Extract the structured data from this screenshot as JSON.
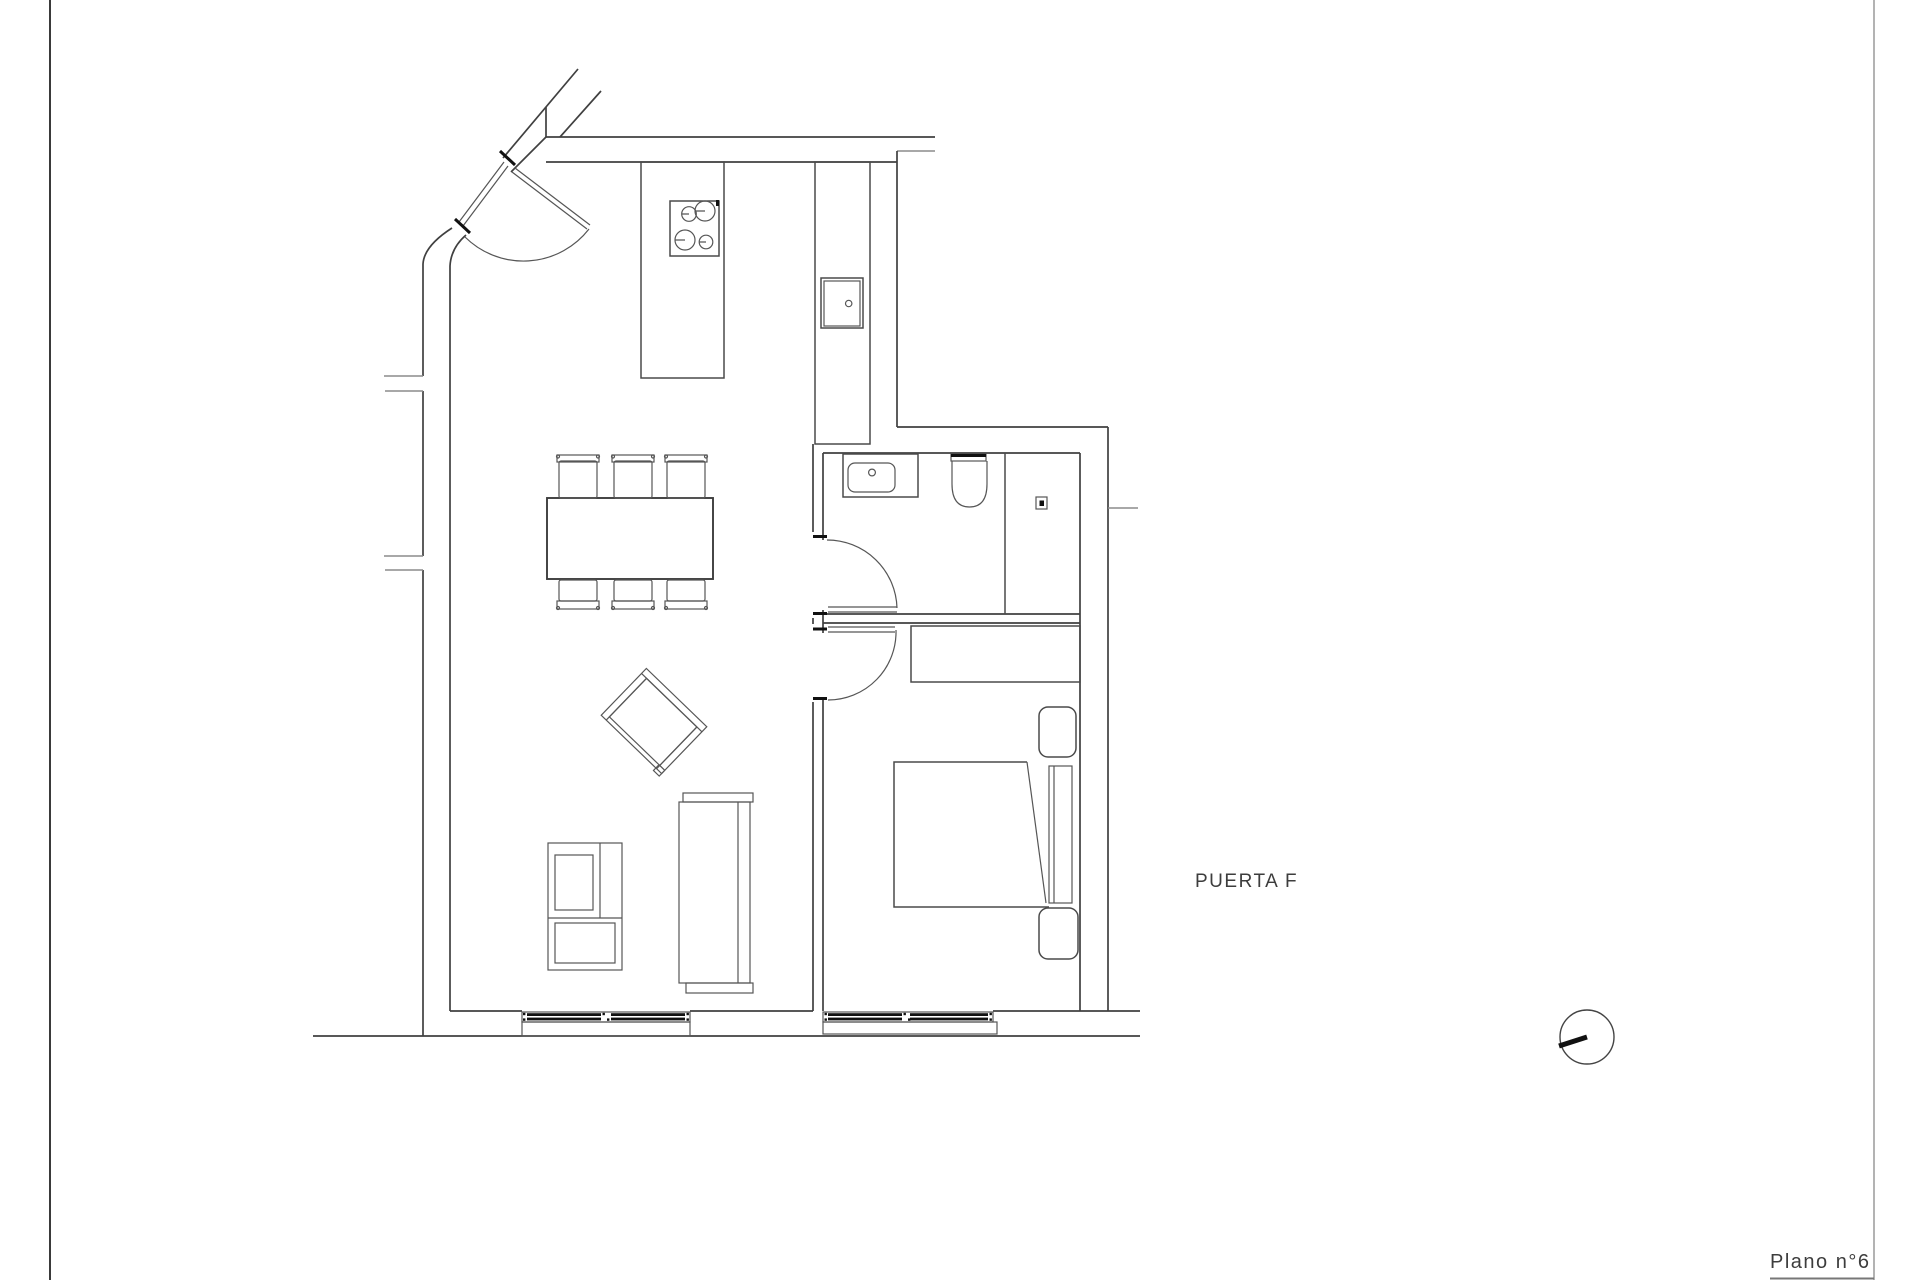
{
  "page": {
    "background": "#ffffff",
    "left_border_color": "#3a3a3a",
    "right_border_color": "#8a8a8a",
    "line_color": "#4a4a4a",
    "accent_black": "#111111"
  },
  "labels": {
    "door_label": "PUERTA F",
    "plan_number": "Plano n°6"
  },
  "drawing": {
    "type": "architectural-floor-plan",
    "symbols": [
      "entrance-door-with-swing",
      "kitchen-counter",
      "stove-4-burners",
      "kitchen-sink",
      "dining-table-6-chairs",
      "armchair-rotated",
      "sofa",
      "tv-cabinet",
      "bathroom-sink",
      "toilet",
      "shower-drain",
      "bathroom-door-with-swing",
      "bedroom-door-with-swing",
      "wardrobe",
      "double-bed",
      "nightstand-top",
      "nightstand-bottom",
      "window-living-room",
      "window-bedroom",
      "orientation-circle-symbol"
    ]
  }
}
